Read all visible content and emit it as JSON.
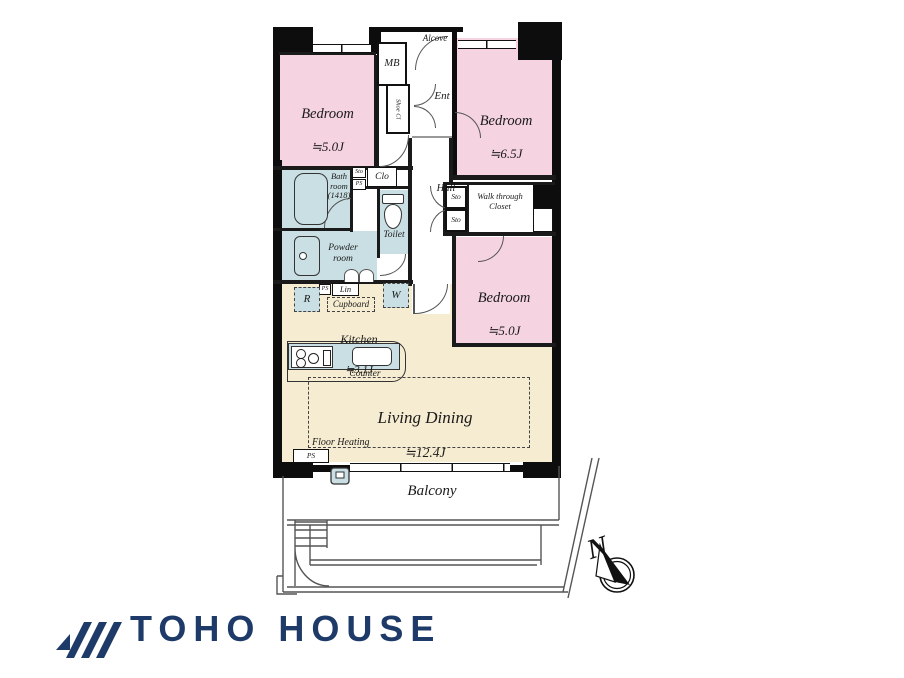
{
  "plan": {
    "labels": {
      "bedroom1_name": "Bedroom",
      "bedroom1_size": "≒5.0J",
      "bedroom2_name": "Bedroom",
      "bedroom2_size": "≒6.5J",
      "bedroom3_name": "Bedroom",
      "bedroom3_size": "≒5.0J",
      "living_name": "Living Dining",
      "living_size": "≒12.4J",
      "kitchen_name": "Kitchen",
      "kitchen_size": "≒3.1J",
      "bath": "Bath\nroom\n(1418)",
      "powder": "Powder\nroom",
      "toilet": "Toilet",
      "hall": "Hall",
      "ent": "Ent",
      "alcove": "Alcove",
      "mb": "MB",
      "shoe_cl": "Shoe Cl",
      "clo": "Clo",
      "sto": "Sto",
      "ps": "PS",
      "lin": "Lin",
      "fridge": "R",
      "washer": "W",
      "cupboard": "Cupboard",
      "counter": "Counter",
      "floor_heating": "Floor Heating",
      "walk_through": "Walk through\nCloset",
      "balcony": "Balcony",
      "compass_north": "N"
    },
    "colors": {
      "bedroom_pink": "#f5d3e1",
      "wet_area_blue": "#c9dfe3",
      "living_cream": "#f6ecd1",
      "wall_black": "#0d0d0d",
      "logo_navy": "#1e3a68"
    }
  },
  "branding": {
    "logo_text": "TOHO HOUSE"
  }
}
